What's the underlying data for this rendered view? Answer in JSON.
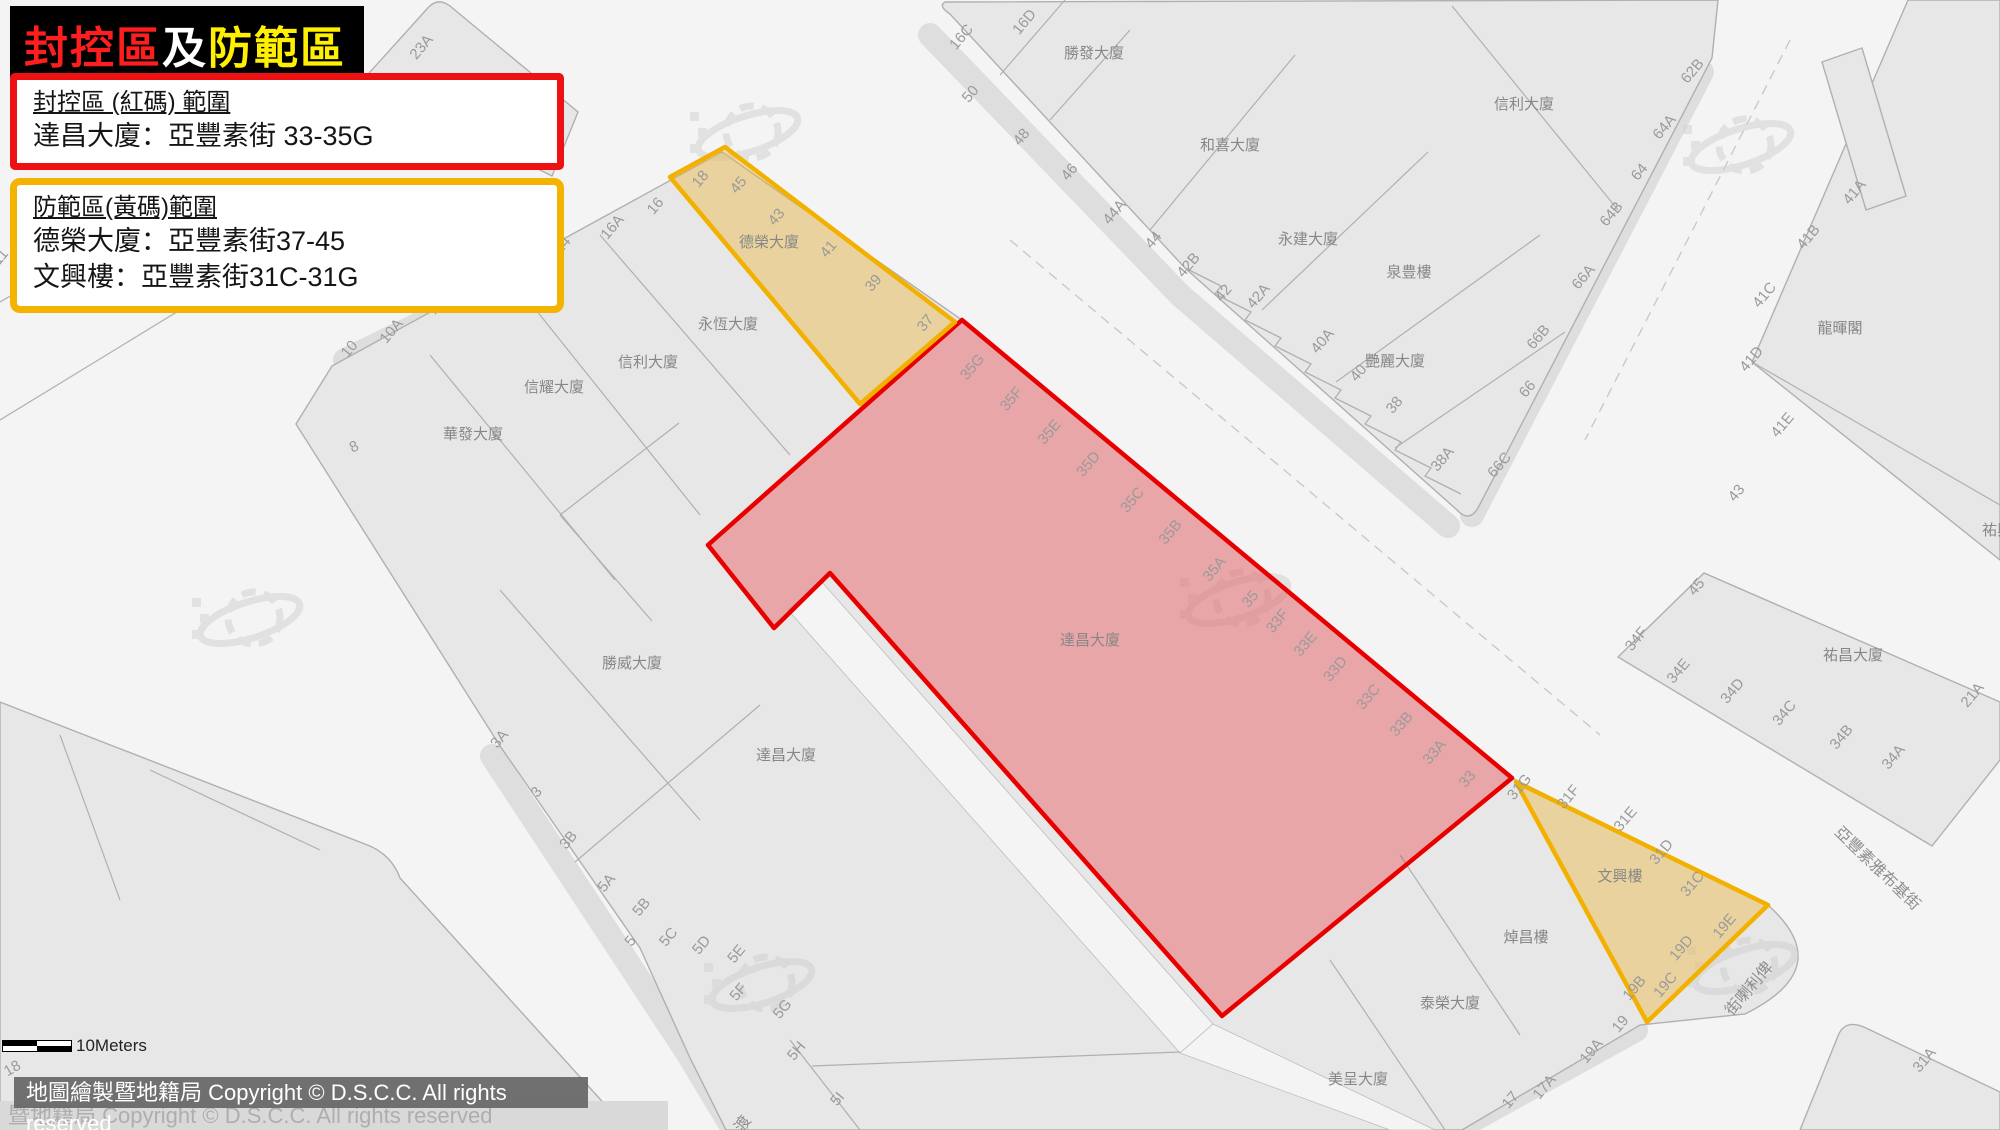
{
  "title": {
    "part_red": "封控區",
    "part_white": "及",
    "part_yellow": "防範區"
  },
  "legend_red": {
    "heading": "封控區 (紅碼) 範圍",
    "line1": "達昌大廈：亞豐素街 33-35G"
  },
  "legend_yellow": {
    "heading": "防範區(黃碼)範圍",
    "line1": "德榮大廈：亞豐素街37-45",
    "line2": "文興樓：亞豐素街31C-31G"
  },
  "scalebar": {
    "label": "10Meters"
  },
  "copyright": {
    "overlay": "地圖繪製暨地籍局 Copyright © D.S.C.C. All rights reserved",
    "watermark": "暨地籍局 Copyright © D.S.C.C. All rights reserved",
    "edge_number": "18"
  },
  "colors": {
    "zone_red_stroke": "#e80000",
    "zone_yellow_stroke": "#f2b100",
    "title_red": "#ff1e1e",
    "title_white": "#ffffff",
    "title_yellow": "#ffef00"
  },
  "map": {
    "zones": [
      {
        "id": "red-lockdown",
        "building": "達昌大廈",
        "type": "red",
        "points": "962,320 1512,778 1222,1016 830,573 774,628 708,545"
      },
      {
        "id": "yellow-prevention-1",
        "building": "德榮大廈",
        "type": "yellow",
        "points": "725,147 670,177 860,404 955,322"
      },
      {
        "id": "yellow-prevention-2",
        "building": "文興樓",
        "type": "yellow",
        "points": "1516,782 1768,905 1647,1022"
      }
    ],
    "buildings": [
      {
        "t": "勝發大廈",
        "x": 1094,
        "y": 58
      },
      {
        "t": "和喜大廈",
        "x": 1230,
        "y": 150
      },
      {
        "t": "信利大廈",
        "x": 1524,
        "y": 109
      },
      {
        "t": "永建大廈",
        "x": 1308,
        "y": 244
      },
      {
        "t": "泉豊樓",
        "x": 1409,
        "y": 277
      },
      {
        "t": "艷麗大廈",
        "x": 1395,
        "y": 366
      },
      {
        "t": "龍暉閣",
        "x": 1840,
        "y": 333
      },
      {
        "t": "祐興大廈",
        "x": 2012,
        "y": 535
      },
      {
        "t": "祐昌大廈",
        "x": 1853,
        "y": 660
      },
      {
        "t": "永恆大廈",
        "x": 728,
        "y": 329
      },
      {
        "t": "信利大廈",
        "x": 648,
        "y": 367
      },
      {
        "t": "信耀大廈",
        "x": 554,
        "y": 392
      },
      {
        "t": "華發大廈",
        "x": 473,
        "y": 439
      },
      {
        "t": "勝威大廈",
        "x": 632,
        "y": 668
      },
      {
        "t": "德榮大廈",
        "x": 769,
        "y": 247
      },
      {
        "t": "達昌大廈",
        "x": 1090,
        "y": 645
      },
      {
        "t": "達昌大廈",
        "x": 786,
        "y": 760
      },
      {
        "t": "文興樓",
        "x": 1620,
        "y": 881
      },
      {
        "t": "焯昌樓",
        "x": 1526,
        "y": 942
      },
      {
        "t": "泰榮大廈",
        "x": 1450,
        "y": 1008
      },
      {
        "t": "美呈大廈",
        "x": 1358,
        "y": 1084
      }
    ],
    "street_numbers": [
      {
        "t": "23A",
        "x": 425,
        "y": 50
      },
      {
        "t": "16C",
        "x": 965,
        "y": 40
      },
      {
        "t": "16D",
        "x": 1028,
        "y": 25
      },
      {
        "t": "50",
        "x": 974,
        "y": 97
      },
      {
        "t": "48",
        "x": 1025,
        "y": 140
      },
      {
        "t": "46",
        "x": 1073,
        "y": 175
      },
      {
        "t": "44A",
        "x": 1118,
        "y": 215
      },
      {
        "t": "44",
        "x": 1157,
        "y": 243
      },
      {
        "t": "42B",
        "x": 1192,
        "y": 268
      },
      {
        "t": "42",
        "x": 1227,
        "y": 296
      },
      {
        "t": "42A",
        "x": 1262,
        "y": 299
      },
      {
        "t": "40A",
        "x": 1326,
        "y": 344
      },
      {
        "t": "40",
        "x": 1362,
        "y": 376
      },
      {
        "t": "38",
        "x": 1398,
        "y": 408
      },
      {
        "t": "38A",
        "x": 1446,
        "y": 462
      },
      {
        "t": "62B",
        "x": 1696,
        "y": 74
      },
      {
        "t": "64A",
        "x": 1668,
        "y": 130
      },
      {
        "t": "64",
        "x": 1643,
        "y": 175
      },
      {
        "t": "64B",
        "x": 1615,
        "y": 217
      },
      {
        "t": "66A",
        "x": 1587,
        "y": 280
      },
      {
        "t": "66B",
        "x": 1542,
        "y": 340
      },
      {
        "t": "66",
        "x": 1531,
        "y": 392
      },
      {
        "t": "66C",
        "x": 1503,
        "y": 468
      },
      {
        "t": "41A",
        "x": 1858,
        "y": 195
      },
      {
        "t": "41B",
        "x": 1812,
        "y": 240
      },
      {
        "t": "41C",
        "x": 1768,
        "y": 298
      },
      {
        "t": "41D",
        "x": 1755,
        "y": 362
      },
      {
        "t": "41E",
        "x": 1786,
        "y": 428
      },
      {
        "t": "43",
        "x": 1740,
        "y": 496
      },
      {
        "t": "45",
        "x": 1700,
        "y": 590
      },
      {
        "t": "34F",
        "x": 1640,
        "y": 642
      },
      {
        "t": "34E",
        "x": 1682,
        "y": 674
      },
      {
        "t": "34D",
        "x": 1736,
        "y": 694
      },
      {
        "t": "34C",
        "x": 1788,
        "y": 716
      },
      {
        "t": "34B",
        "x": 1845,
        "y": 740
      },
      {
        "t": "34A",
        "x": 1897,
        "y": 760
      },
      {
        "t": "21A",
        "x": 1976,
        "y": 698
      },
      {
        "t": "16",
        "x": 659,
        "y": 209
      },
      {
        "t": "16A",
        "x": 616,
        "y": 230
      },
      {
        "t": "14",
        "x": 566,
        "y": 248
      },
      {
        "t": "12",
        "x": 440,
        "y": 309
      },
      {
        "t": "10A",
        "x": 395,
        "y": 334
      },
      {
        "t": "10",
        "x": 353,
        "y": 352
      },
      {
        "t": "8",
        "x": 356,
        "y": 451,
        "r": -25
      },
      {
        "t": "11",
        "x": 4,
        "y": 260
      },
      {
        "t": "18",
        "x": 704,
        "y": 182
      },
      {
        "t": "45",
        "x": 742,
        "y": 188
      },
      {
        "t": "43",
        "x": 780,
        "y": 220
      },
      {
        "t": "41",
        "x": 832,
        "y": 252
      },
      {
        "t": "39",
        "x": 877,
        "y": 286
      },
      {
        "t": "37",
        "x": 929,
        "y": 326
      },
      {
        "t": "35G",
        "x": 976,
        "y": 370
      },
      {
        "t": "35F",
        "x": 1015,
        "y": 402
      },
      {
        "t": "35E",
        "x": 1053,
        "y": 435
      },
      {
        "t": "35D",
        "x": 1092,
        "y": 467
      },
      {
        "t": "35C",
        "x": 1136,
        "y": 503
      },
      {
        "t": "35B",
        "x": 1174,
        "y": 535
      },
      {
        "t": "35A",
        "x": 1218,
        "y": 572
      },
      {
        "t": "35",
        "x": 1254,
        "y": 602
      },
      {
        "t": "33F",
        "x": 1281,
        "y": 624
      },
      {
        "t": "33E",
        "x": 1309,
        "y": 647
      },
      {
        "t": "33D",
        "x": 1339,
        "y": 672
      },
      {
        "t": "33C",
        "x": 1372,
        "y": 700
      },
      {
        "t": "33B",
        "x": 1405,
        "y": 727
      },
      {
        "t": "33A",
        "x": 1438,
        "y": 755
      },
      {
        "t": "33",
        "x": 1471,
        "y": 782
      },
      {
        "t": "31G",
        "x": 1523,
        "y": 790
      },
      {
        "t": "31F",
        "x": 1572,
        "y": 800
      },
      {
        "t": "31E",
        "x": 1629,
        "y": 822
      },
      {
        "t": "31D",
        "x": 1665,
        "y": 855
      },
      {
        "t": "31C",
        "x": 1696,
        "y": 887
      },
      {
        "t": "19E",
        "x": 1728,
        "y": 929
      },
      {
        "t": "19D",
        "x": 1685,
        "y": 951
      },
      {
        "t": "19C",
        "x": 1669,
        "y": 988
      },
      {
        "t": "19B",
        "x": 1638,
        "y": 991
      },
      {
        "t": "19",
        "x": 1624,
        "y": 1027
      },
      {
        "t": "19A",
        "x": 1595,
        "y": 1054
      },
      {
        "t": "17A",
        "x": 1548,
        "y": 1090
      },
      {
        "t": "17",
        "x": 1514,
        "y": 1103
      },
      {
        "t": "31A",
        "x": 1928,
        "y": 1063
      },
      {
        "t": "3A",
        "x": 503,
        "y": 742
      },
      {
        "t": "3",
        "x": 540,
        "y": 795
      },
      {
        "t": "3B",
        "x": 572,
        "y": 843
      },
      {
        "t": "5A",
        "x": 610,
        "y": 886
      },
      {
        "t": "5B",
        "x": 645,
        "y": 910
      },
      {
        "t": "5",
        "x": 634,
        "y": 944
      },
      {
        "t": "5C",
        "x": 672,
        "y": 940
      },
      {
        "t": "5D",
        "x": 705,
        "y": 948
      },
      {
        "t": "5E",
        "x": 740,
        "y": 957
      },
      {
        "t": "5F",
        "x": 742,
        "y": 995
      },
      {
        "t": "5G",
        "x": 786,
        "y": 1012
      },
      {
        "t": "5H",
        "x": 800,
        "y": 1054
      },
      {
        "t": "5I",
        "x": 841,
        "y": 1102
      }
    ],
    "street_names": [
      {
        "t": "俾利喇街",
        "display": "街喇利俾",
        "x": 1753,
        "y": 992,
        "r": -50
      },
      {
        "t": "亞豐素雅布基街",
        "x": 1874,
        "y": 872,
        "r": 44,
        "anchor": "start"
      },
      {
        "t": "渡",
        "x": 747,
        "y": 1127,
        "r": -55
      }
    ]
  }
}
